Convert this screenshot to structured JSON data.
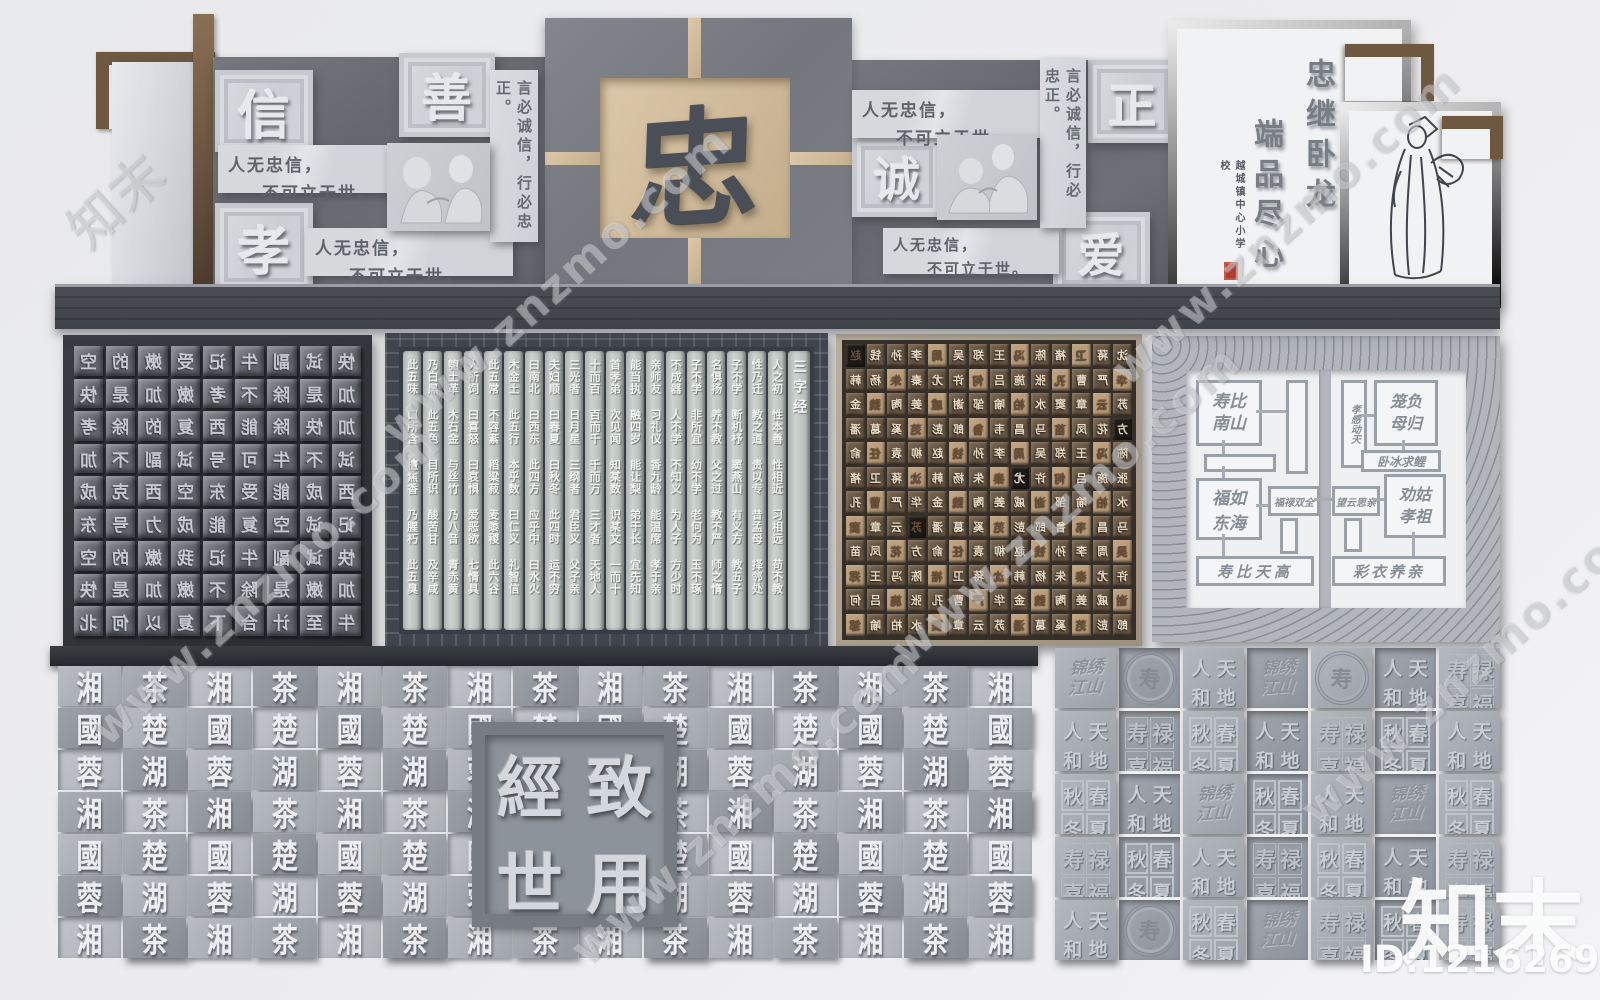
{
  "watermark": {
    "brand": "知末",
    "site": "www.znzmo.com",
    "id_text": "ID:1216269527"
  },
  "top_wall": {
    "virtues": [
      "信",
      "善",
      "孝",
      "诚",
      "正",
      "爱"
    ],
    "center_char": "忠",
    "quote_line1": "人无忠信，",
    "quote_line2": "不可立于世。",
    "vertical_quote": "言必诚信，行必忠正。",
    "right_panel": {
      "line1": "忠继卧龙",
      "line2": "端品尽心",
      "school": "越城镇中心小学校"
    }
  },
  "type_panel": {
    "rows": [
      "空的嫩受记牛副试快",
      "快是加嫩考不除是加",
      "考除的复西能除快加",
      "加不副试号可牛不试",
      "成克西空东受能成西",
      "东号力成能复空试记",
      "空的嫩我记牛副试快",
      "快是加嫩不除是嫩加",
      "北何以复下合计至牛"
    ]
  },
  "sanzijing": {
    "title": "三字经",
    "columns": [
      "人之初 性本善 性相近 习相远 苟不教",
      "性乃迁 教之道 贵以专 昔孟母 择邻处",
      "子不学 断机杼 窦燕山 有义方 教五子",
      "名俱扬 养不教 父之过 教不严 师之惰",
      "子不学 非所宜 幼不学 老何为 玉不琢",
      "不成器 人不学 不知义 为人子 方少时",
      "亲师友 习礼仪 香九龄 能温席 孝于亲",
      "能当执 融四岁 能让梨 弟于长 宜先知",
      "首孝弟 次见闻 知某数 识某文 一而十",
      "十而百 百而千 千而万 三才者 天地人",
      "三光者 日月星 三纲者 君臣义 父子亲",
      "夫妇顺 曰春夏 曰秋冬 此四时 运不穷",
      "曰南北 曰西东 此四方 应乎中 曰水火",
      "木金土 此五行 本乎数 曰仁义 礼智信",
      "此五常 不容紊 稻粱菽 麦黍稷 此六谷",
      "人所饲 曰喜怒 曰哀惧 爱恶欲 七情具",
      "匏土革 木石金 与丝竹 乃八音 青赤黄",
      "乃白黑 此五色 目所识 酸苦甘 及辛咸",
      "此五味 口所含 檀焦香 乃腥朽 此五臭"
    ]
  },
  "surname_panel": {
    "charset": "赵钱孙李周吴郑王冯陈褚卫蒋沈韩杨朱秦尤许何吕施张孔曹严华金魏陶姜戚谢邹喻柏水窦章云苏潘葛奚范彭郎鲁韦昌马苗凤花方俞任袁柳"
  },
  "blessing_panel": {
    "boxes": {
      "b1": "寿比南山",
      "b2": "福如东海",
      "b3": "福禄双全",
      "b4": "寿比天高",
      "b5": "孝感动天",
      "b6": "笼负母归",
      "b7": "卧冰求鲤",
      "b8": "望云思亲",
      "b9": "劝姑孝祖",
      "b10": "彩衣养亲"
    }
  },
  "seal_wall": {
    "center_chars": [
      "經",
      "致",
      "世",
      "用"
    ],
    "charset": "湘湖國茶蓉楚"
  },
  "tile_wall": {
    "tiles": {
      "jinxiu": {
        "label": "锦绣江山",
        "lines": [
          "锦绣",
          "江山"
        ]
      },
      "medallion": {
        "label": "团寿纹",
        "char": "寿"
      },
      "tiandi": {
        "label": "天地人和",
        "chars": [
          "人",
          "天",
          "和",
          "地"
        ]
      },
      "chunxia": {
        "label": "春夏秋冬",
        "chars": [
          "秋",
          "春",
          "冬",
          "夏"
        ]
      },
      "fulu": {
        "label": "福禄寿喜",
        "chars": [
          "寿",
          "禄",
          "喜",
          "福"
        ]
      }
    },
    "pattern": [
      "jinxiu",
      "medallion",
      "tiandi",
      "jinxiu",
      "medallion",
      "tiandi",
      "fulu",
      "tiandi",
      "fulu",
      "chunxia",
      "tiandi",
      "fulu",
      "chunxia",
      "tiandi",
      "chunxia",
      "tiandi",
      "jinxiu",
      "chunxia",
      "tiandi",
      "jinxiu",
      "chunxia",
      "fulu",
      "chunxia",
      "tiandi",
      "fulu",
      "chunxia",
      "tiandi",
      "fulu",
      "tiandi",
      "medallion",
      "chunxia",
      "jinxiu",
      "fulu",
      "chunxia",
      "fulu"
    ]
  }
}
